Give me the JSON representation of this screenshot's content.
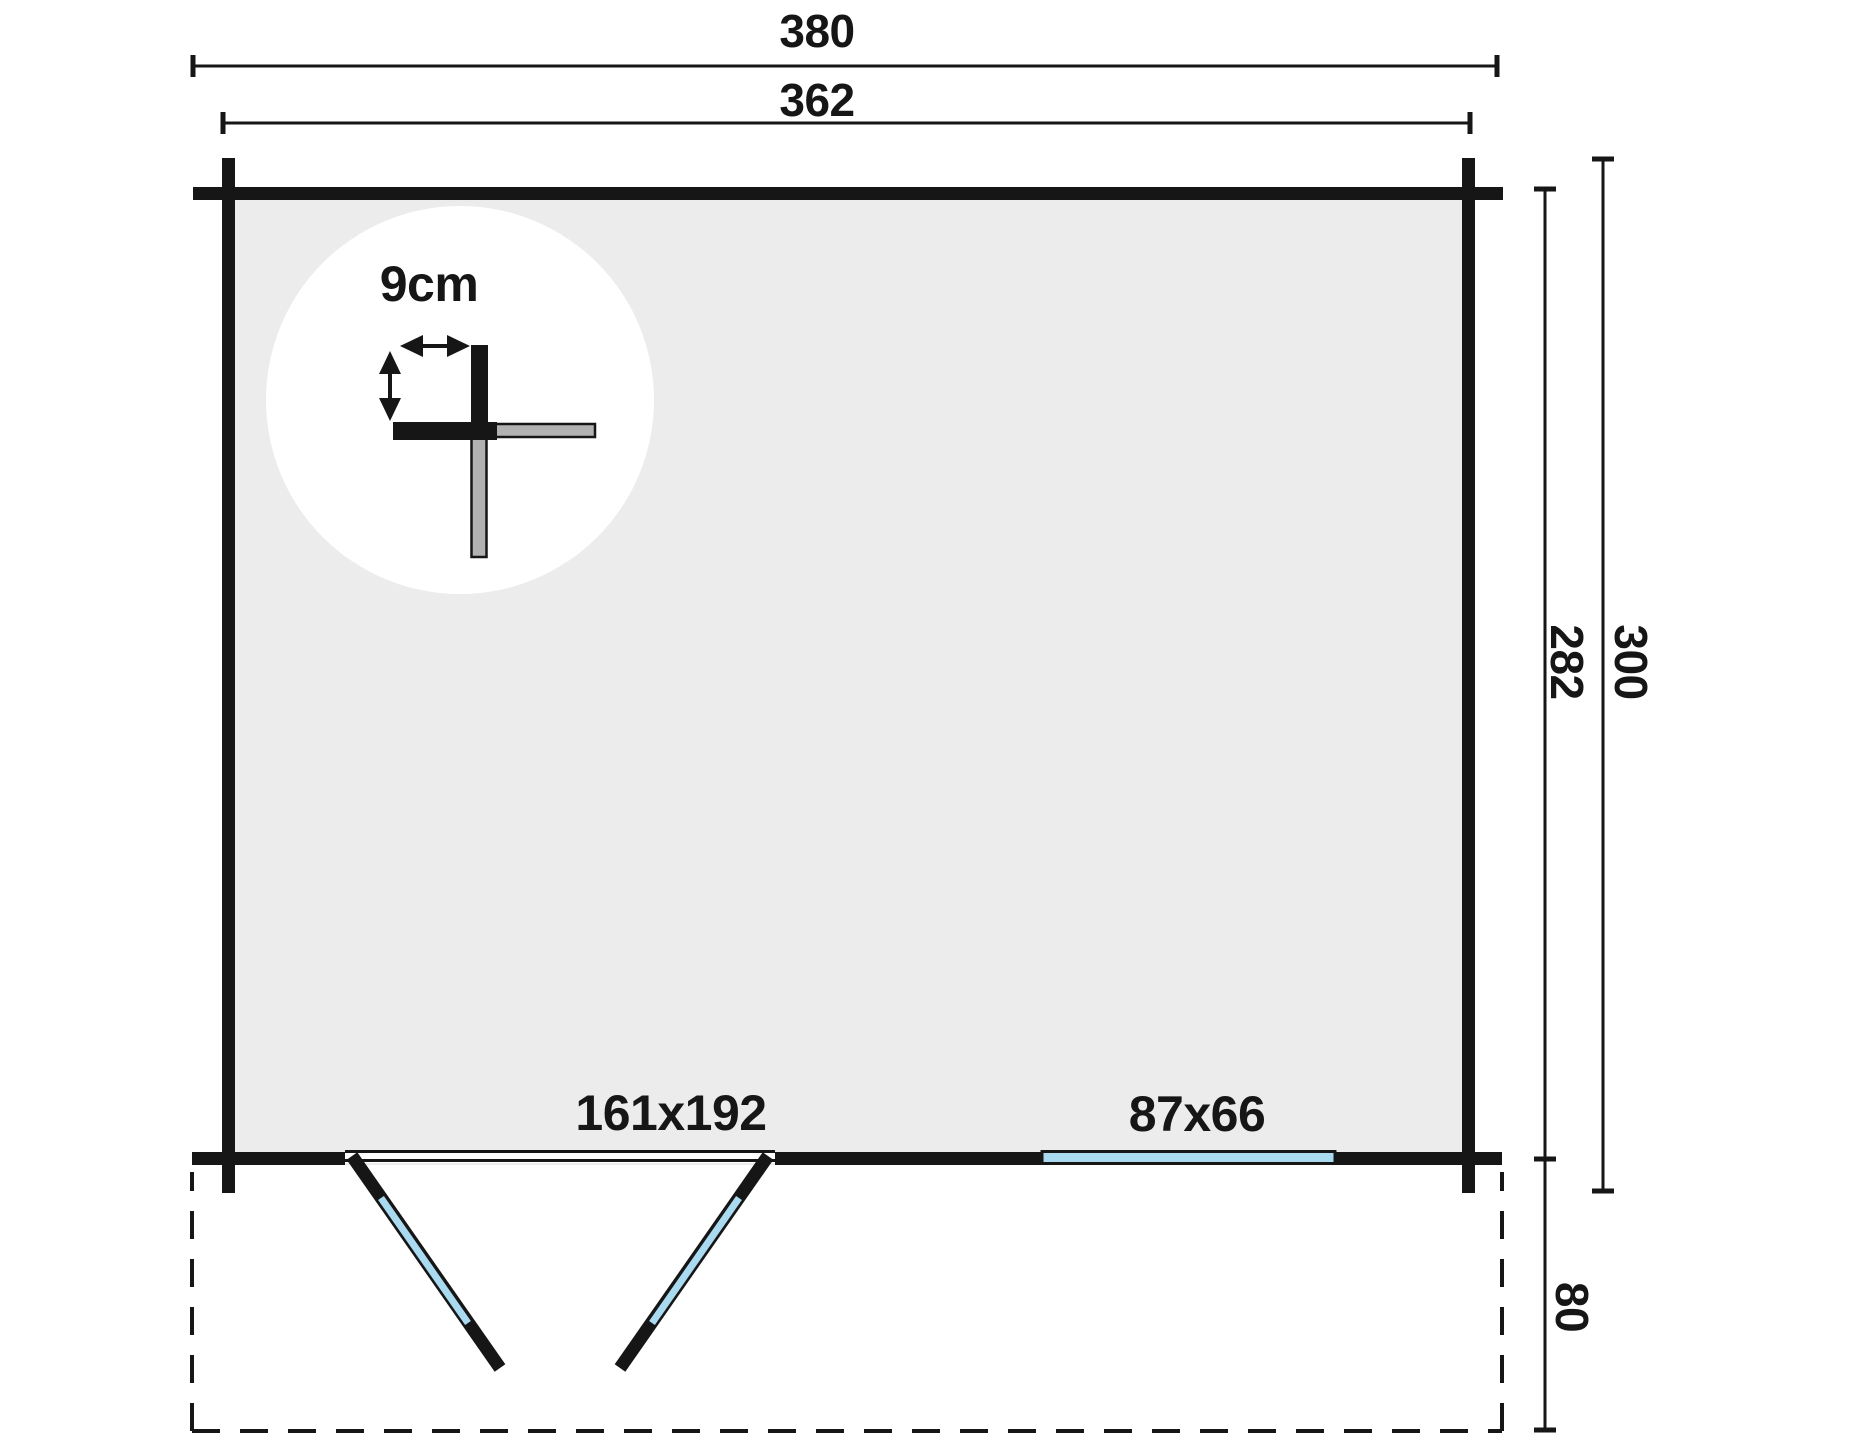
{
  "diagram": {
    "type": "cabin-floor-plan",
    "dimensions": {
      "outer_width": "380",
      "wall_width": "362",
      "wall_depth": "282",
      "outer_depth": "300",
      "terrace_depth": "80"
    },
    "wall_detail": {
      "thickness_label": "9cm"
    },
    "openings": {
      "double_door": "161x192",
      "window": "87x66"
    },
    "colors": {
      "line": "#161616",
      "interior": "#ececec",
      "log": "#b2b2b2",
      "glazing": "#a9daf0",
      "paper": "#ffffff"
    }
  }
}
